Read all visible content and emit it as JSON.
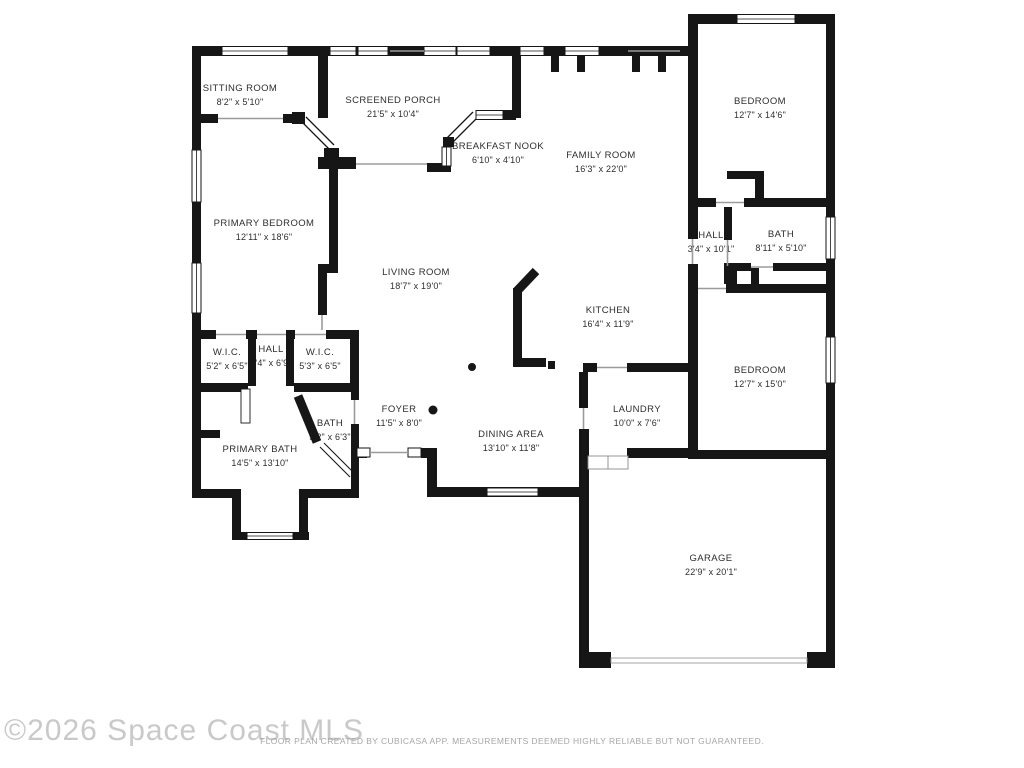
{
  "watermark": "©2026 Space Coast MLS",
  "disclaimer": "FLOOR PLAN CREATED BY CUBICASA APP. MEASUREMENTS DEEMED HIGHLY RELIABLE BUT NOT GUARANTEED.",
  "plan": {
    "wall_color": "#161616",
    "background": "#ffffff",
    "door_line_color": "#9b9b9b"
  },
  "rooms": [
    {
      "name": "SITTING ROOM",
      "dims": "8'2\" x 5'10\""
    },
    {
      "name": "SCREENED PORCH",
      "dims": "21'5\" x 10'4\""
    },
    {
      "name": "BREAKFAST NOOK",
      "dims": "6'10\" x 4'10\""
    },
    {
      "name": "FAMILY ROOM",
      "dims": "16'3\" x 22'0\""
    },
    {
      "name": "BEDROOM",
      "dims": "12'7\" x 14'6\""
    },
    {
      "name": "PRIMARY BEDROOM",
      "dims": "12'11\" x 18'6\""
    },
    {
      "name": "LIVING ROOM",
      "dims": "18'7\" x 19'0\""
    },
    {
      "name": "HALL",
      "dims": "3'4\" x 10'1\""
    },
    {
      "name": "BATH",
      "dims": "8'11\" x 5'10\""
    },
    {
      "name": "KITCHEN",
      "dims": "16'4\" x 11'9\""
    },
    {
      "name": "W.I.C.",
      "dims": "5'2\" x 6'5\""
    },
    {
      "name": "HALL",
      "dims": "3'4\" x 6'9\""
    },
    {
      "name": "W.I.C.",
      "dims": "5'3\" x 6'5\""
    },
    {
      "name": "BEDROOM",
      "dims": "12'7\" x 15'0\""
    },
    {
      "name": "FOYER",
      "dims": "11'5\" x 8'0\""
    },
    {
      "name": "BATH",
      "dims": "5'2\" x 6'3\""
    },
    {
      "name": "LAUNDRY",
      "dims": "10'0\" x 7'6\""
    },
    {
      "name": "PRIMARY BATH",
      "dims": "14'5\" x 13'10\""
    },
    {
      "name": "DINING AREA",
      "dims": "13'10\" x 11'8\""
    },
    {
      "name": "GARAGE",
      "dims": "22'9\" x 20'1\""
    }
  ]
}
